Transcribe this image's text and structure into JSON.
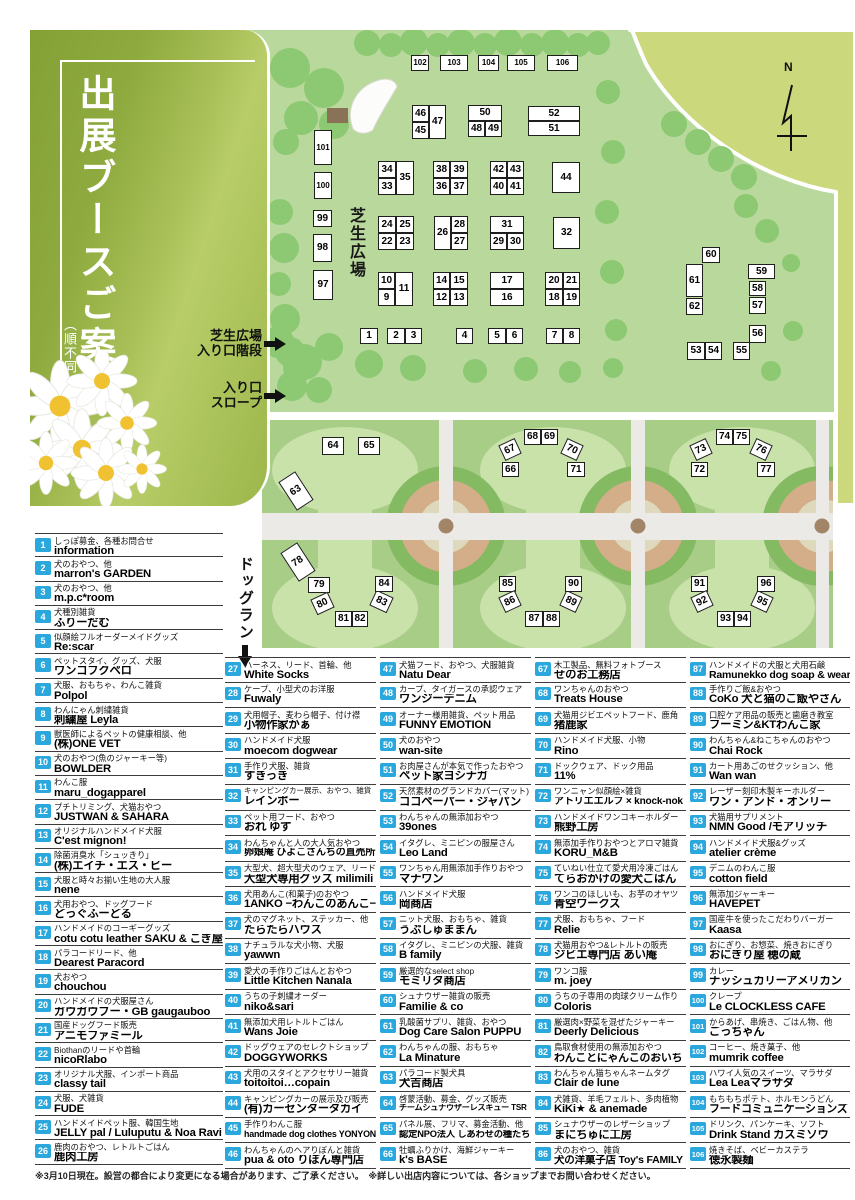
{
  "title": {
    "main": "出展ブースご案内",
    "sub": "（順不同）"
  },
  "map_labels": {
    "north": "N",
    "lawn": "芝生広場",
    "stairs_line1": "芝生広場",
    "stairs_line2": "入り口階段",
    "slope_line1": "入り口",
    "slope_line2": "スロープ",
    "dogrun": "ドッグラン"
  },
  "colors": {
    "badge_blue": "#2aa7dc",
    "panel_green": "#94b04a",
    "lawn_green": "#b9d99c",
    "tree_green": "#8dc873",
    "dogrun_green": "#a7cd87",
    "paddock_green": "#c8e2a9",
    "road_gray": "#eceae6",
    "ring_tan": "#d3ae88",
    "ring_green": "#84ba62",
    "wedge_green": "#cbd87c"
  },
  "map_boxes": [
    [
      1,
      360,
      328,
      18,
      16,
      0
    ],
    [
      2,
      387,
      328,
      18,
      16,
      0
    ],
    [
      3,
      405,
      328,
      17,
      16,
      0
    ],
    [
      4,
      456,
      328,
      17,
      16,
      0
    ],
    [
      5,
      488,
      328,
      18,
      16,
      0
    ],
    [
      6,
      506,
      328,
      17,
      16,
      0
    ],
    [
      7,
      546,
      328,
      17,
      16,
      0
    ],
    [
      8,
      563,
      328,
      17,
      16,
      0
    ],
    [
      9,
      378,
      289,
      17,
      17,
      0
    ],
    [
      10,
      378,
      272,
      17,
      17,
      0
    ],
    [
      11,
      395,
      272,
      18,
      34,
      0
    ],
    [
      12,
      433,
      289,
      17,
      17,
      0
    ],
    [
      13,
      450,
      289,
      18,
      17,
      0
    ],
    [
      14,
      433,
      272,
      17,
      17,
      0
    ],
    [
      15,
      450,
      272,
      18,
      17,
      0
    ],
    [
      16,
      490,
      289,
      34,
      17,
      0
    ],
    [
      17,
      490,
      272,
      34,
      17,
      0
    ],
    [
      18,
      545,
      289,
      18,
      17,
      0
    ],
    [
      19,
      563,
      289,
      17,
      17,
      0
    ],
    [
      20,
      545,
      272,
      18,
      17,
      0
    ],
    [
      21,
      563,
      272,
      17,
      17,
      0
    ],
    [
      22,
      378,
      233,
      18,
      17,
      0
    ],
    [
      23,
      396,
      233,
      18,
      17,
      0
    ],
    [
      24,
      378,
      216,
      18,
      17,
      0
    ],
    [
      25,
      396,
      216,
      18,
      17,
      0
    ],
    [
      26,
      434,
      216,
      17,
      34,
      0
    ],
    [
      27,
      451,
      233,
      17,
      17,
      0
    ],
    [
      28,
      451,
      216,
      17,
      17,
      0
    ],
    [
      29,
      490,
      233,
      17,
      17,
      0
    ],
    [
      30,
      507,
      233,
      17,
      17,
      0
    ],
    [
      31,
      490,
      216,
      34,
      17,
      0
    ],
    [
      32,
      553,
      217,
      27,
      32,
      0
    ],
    [
      33,
      378,
      178,
      18,
      17,
      0
    ],
    [
      34,
      378,
      161,
      18,
      17,
      0
    ],
    [
      35,
      396,
      161,
      18,
      34,
      0
    ],
    [
      36,
      433,
      178,
      17,
      17,
      0
    ],
    [
      37,
      450,
      178,
      18,
      17,
      0
    ],
    [
      38,
      433,
      161,
      17,
      17,
      0
    ],
    [
      39,
      450,
      161,
      18,
      17,
      0
    ],
    [
      40,
      490,
      178,
      17,
      17,
      0
    ],
    [
      41,
      507,
      178,
      17,
      17,
      0
    ],
    [
      42,
      490,
      161,
      17,
      17,
      0
    ],
    [
      43,
      507,
      161,
      17,
      17,
      0
    ],
    [
      44,
      552,
      162,
      28,
      31,
      0
    ],
    [
      45,
      412,
      122,
      17,
      17,
      0
    ],
    [
      46,
      412,
      105,
      17,
      17,
      0
    ],
    [
      47,
      429,
      105,
      17,
      34,
      0
    ],
    [
      48,
      468,
      121,
      17,
      16,
      0
    ],
    [
      49,
      485,
      121,
      17,
      16,
      0
    ],
    [
      50,
      468,
      105,
      34,
      16,
      0
    ],
    [
      51,
      528,
      121,
      52,
      15,
      0
    ],
    [
      52,
      528,
      106,
      52,
      15,
      0
    ],
    [
      53,
      687,
      342,
      18,
      18,
      0
    ],
    [
      54,
      705,
      342,
      17,
      18,
      0
    ],
    [
      55,
      733,
      342,
      17,
      18,
      0
    ],
    [
      56,
      749,
      325,
      17,
      18,
      0
    ],
    [
      57,
      749,
      297,
      17,
      17,
      0
    ],
    [
      58,
      749,
      281,
      17,
      15,
      0
    ],
    [
      59,
      748,
      264,
      27,
      15,
      0
    ],
    [
      60,
      702,
      247,
      18,
      16,
      0
    ],
    [
      61,
      686,
      264,
      17,
      33,
      0
    ],
    [
      62,
      686,
      298,
      17,
      17,
      0
    ],
    [
      63,
      286,
      474,
      20,
      34,
      -33
    ],
    [
      64,
      322,
      437,
      22,
      18,
      0
    ],
    [
      65,
      358,
      437,
      22,
      18,
      0
    ],
    [
      66,
      502,
      462,
      17,
      15,
      0
    ],
    [
      67,
      501,
      441,
      18,
      17,
      -25
    ],
    [
      68,
      524,
      429,
      17,
      16,
      0
    ],
    [
      69,
      541,
      429,
      17,
      16,
      0
    ],
    [
      70,
      563,
      441,
      18,
      17,
      25
    ],
    [
      71,
      567,
      462,
      18,
      15,
      0
    ],
    [
      72,
      691,
      462,
      17,
      15,
      0
    ],
    [
      73,
      692,
      441,
      18,
      17,
      -25
    ],
    [
      74,
      716,
      429,
      17,
      16,
      0
    ],
    [
      75,
      733,
      429,
      17,
      16,
      0
    ],
    [
      76,
      752,
      441,
      18,
      17,
      25
    ],
    [
      77,
      757,
      462,
      18,
      15,
      0
    ],
    [
      78,
      288,
      545,
      20,
      34,
      -33
    ],
    [
      79,
      308,
      577,
      22,
      16,
      0
    ],
    [
      80,
      313,
      595,
      19,
      17,
      -25
    ],
    [
      81,
      335,
      611,
      17,
      16,
      0
    ],
    [
      82,
      352,
      611,
      16,
      16,
      0
    ],
    [
      83,
      372,
      593,
      19,
      17,
      25
    ],
    [
      84,
      375,
      576,
      18,
      16,
      0
    ],
    [
      85,
      499,
      576,
      17,
      16,
      0
    ],
    [
      86,
      501,
      593,
      18,
      17,
      -25
    ],
    [
      87,
      525,
      611,
      18,
      16,
      0
    ],
    [
      88,
      543,
      611,
      17,
      16,
      0
    ],
    [
      89,
      562,
      593,
      18,
      17,
      25
    ],
    [
      90,
      565,
      576,
      17,
      16,
      0
    ],
    [
      91,
      691,
      576,
      17,
      16,
      0
    ],
    [
      92,
      693,
      593,
      18,
      17,
      -25
    ],
    [
      93,
      717,
      611,
      17,
      16,
      0
    ],
    [
      94,
      734,
      611,
      17,
      16,
      0
    ],
    [
      95,
      753,
      593,
      18,
      17,
      25
    ],
    [
      96,
      757,
      576,
      18,
      16,
      0
    ],
    [
      97,
      313,
      270,
      20,
      30,
      0
    ],
    [
      98,
      313,
      234,
      19,
      28,
      0
    ],
    [
      99,
      313,
      210,
      19,
      17,
      0
    ],
    [
      100,
      314,
      172,
      18,
      27,
      0
    ],
    [
      101,
      314,
      130,
      18,
      35,
      0
    ],
    [
      102,
      411,
      55,
      18,
      16,
      0
    ],
    [
      103,
      440,
      55,
      28,
      16,
      0
    ],
    [
      104,
      478,
      55,
      21,
      16,
      0
    ],
    [
      105,
      507,
      55,
      28,
      16,
      0
    ],
    [
      106,
      547,
      55,
      31,
      16,
      0
    ]
  ],
  "booths": [
    {
      "n": 1,
      "desc": "しっぽ募金、各種お問合せ",
      "name": "information"
    },
    {
      "n": 2,
      "desc": "犬のおやつ、他",
      "name": "marron's GARDEN"
    },
    {
      "n": 3,
      "desc": "犬のおやつ、他",
      "name": "m.p.c*room"
    },
    {
      "n": 4,
      "desc": "犬種別雑貨",
      "name": "ふりーだむ"
    },
    {
      "n": 5,
      "desc": "似顔絵フルオーダーメイドグッズ",
      "name": "Re:scar"
    },
    {
      "n": 6,
      "desc": "ペットスタイ、グッズ、犬服",
      "name": "ワンコフクペロ"
    },
    {
      "n": 7,
      "desc": "犬服、おもちゃ、わんこ雑貨",
      "name": "Polpol"
    },
    {
      "n": 8,
      "desc": "わんにゃん刺繍雑貨",
      "name": "刺繍屋 Leyla"
    },
    {
      "n": 9,
      "desc": "獣医師によるペットの健康相談、他",
      "name": "(株)ONE VET"
    },
    {
      "n": 10,
      "desc": "犬のおやつ(魚のジャーキー等)",
      "name": "BOWLDER"
    },
    {
      "n": 11,
      "desc": "わんこ服",
      "name": "maru_dogapparel"
    },
    {
      "n": 12,
      "desc": "プチトリミング、犬猫おやつ",
      "name": "JUSTWAN & SAHARA"
    },
    {
      "n": 13,
      "desc": "オリジナルハンドメイド犬服",
      "name": "C'est mignon!"
    },
    {
      "n": 14,
      "desc": "除菌消臭水「シュッきり」",
      "name": "(株)エイチ・エス・ビー"
    },
    {
      "n": 15,
      "desc": "犬服と時々お揃い生地の大人服",
      "name": "nene"
    },
    {
      "n": 16,
      "desc": "犬用おやつ、ドッグフード",
      "name": "どっぐふーどる"
    },
    {
      "n": 17,
      "desc": "ハンドメイドのコーギーグッズ",
      "name": "cotu cotu leather SAKU & こぎ屋"
    },
    {
      "n": 18,
      "desc": "パラコードリード、他",
      "name": "Dearest Paracord"
    },
    {
      "n": 19,
      "desc": "犬おやつ",
      "name": "chouchou"
    },
    {
      "n": 20,
      "desc": "ハンドメイドの犬服屋さん",
      "name": "ガウガウブー・GB gaugauboo"
    },
    {
      "n": 21,
      "desc": "国産ドッグフード販売",
      "name": "アニモファミール"
    },
    {
      "n": 22,
      "desc": "Biothanのリードや首輪",
      "name": "nicoRlabo"
    },
    {
      "n": 23,
      "desc": "オリジナル犬服、インポート商品",
      "name": "classy tail"
    },
    {
      "n": 24,
      "desc": "犬服、犬雑貨",
      "name": "FUDE"
    },
    {
      "n": 25,
      "desc": "ハンドメイドペット服、韓国生地",
      "name": "JELLY pal / Luluputu & Noa Ravi"
    },
    {
      "n": 26,
      "desc": "鹿肉のおやつ、レトルトごはん",
      "name": "鹿肉工房"
    },
    {
      "n": 27,
      "desc": "ハーネス、リード、首輪、他",
      "name": "White Socks"
    },
    {
      "n": 28,
      "desc": "ケープ、小型犬のお洋服",
      "name": "Fuwaly"
    },
    {
      "n": 29,
      "desc": "犬用帽子、麦わら帽子、付け襟",
      "name": "小物作家かぁ"
    },
    {
      "n": 30,
      "desc": "ハンドメイド犬服",
      "name": "moecom dogwear"
    },
    {
      "n": 31,
      "desc": "手作り犬服、雑貨",
      "name": "すきっき"
    },
    {
      "n": 32,
      "desc": "キャンピングカー展示、おやつ、雑貨",
      "name": "レインボー"
    },
    {
      "n": 33,
      "desc": "ペット用フード、おやつ",
      "name": "おれ ゆず"
    },
    {
      "n": 34,
      "desc": "わんちゃんと人の大人気おやつ",
      "name": "卵娘庵 ひよこさんちの直売所"
    },
    {
      "n": 35,
      "desc": "大型犬、超大型犬のウェア、リード",
      "name": "大型犬専用グッズ milimili"
    },
    {
      "n": 36,
      "desc": "犬用あんこ(和菓子)のおやつ",
      "name": "1ANKO −わんこのあんこ−"
    },
    {
      "n": 37,
      "desc": "犬のマグネット、ステッカー、他",
      "name": "たらたらハウス"
    },
    {
      "n": 38,
      "desc": "ナチュラルな犬小物、犬服",
      "name": "yawwn"
    },
    {
      "n": 39,
      "desc": "愛犬の手作りごはんとおやつ",
      "name": "Little Kitchen Nanala"
    },
    {
      "n": 40,
      "desc": "うちの子刺繍オーダー",
      "name": "niko&sari"
    },
    {
      "n": 41,
      "desc": "無添加犬用レトルトごはん",
      "name": "Wans Joie"
    },
    {
      "n": 42,
      "desc": "ドッグウェアのセレクトショップ",
      "name": "DOGGYWORKS"
    },
    {
      "n": 43,
      "desc": "犬用のスタイとアクセサリー雑貨",
      "name": "toitoitoi…copain"
    },
    {
      "n": 44,
      "desc": "キャンピングカーの展示及び販売",
      "name": "(有)カーセンタータカイ"
    },
    {
      "n": 45,
      "desc": "手作りわんこ服",
      "name": "handmade dog clothes YONYON"
    },
    {
      "n": 46,
      "desc": "わんちゃんのヘアりぼんと雑貨",
      "name": "pua & oto りぼん専門店"
    },
    {
      "n": 47,
      "desc": "犬猫フード、おやつ、犬服雑貨",
      "name": "Natu Dear"
    },
    {
      "n": 48,
      "desc": "カープ、タイガースの承認ウェア",
      "name": "ワンジーデニム"
    },
    {
      "n": 49,
      "desc": "オーナー様用雑貨、ペット用品",
      "name": "FUNNY EMOTION"
    },
    {
      "n": 50,
      "desc": "犬のおやつ",
      "name": "wan-site"
    },
    {
      "n": 51,
      "desc": "お肉屋さんが本気で作ったおやつ",
      "name": "ペット家ヨシナガ"
    },
    {
      "n": 52,
      "desc": "天然素材のグランドカバー(マット)",
      "name": "ココペーパー・ジャパン"
    },
    {
      "n": 53,
      "desc": "わんちゃんの無添加おやつ",
      "name": "39ones"
    },
    {
      "n": 54,
      "desc": "イタグレ、ミニピンの服屋さん",
      "name": "Leo Land"
    },
    {
      "n": 55,
      "desc": "ワンちゃん用無添加手作りおやつ",
      "name": "マナワン"
    },
    {
      "n": 56,
      "desc": "ハンドメイド犬服",
      "name": "岡商店"
    },
    {
      "n": 57,
      "desc": "ニット犬服、おもちゃ、雑貨",
      "name": "うぶしゅままん"
    },
    {
      "n": 58,
      "desc": "イタグレ、ミニピンの犬服、雑貨",
      "name": "B family"
    },
    {
      "n": 59,
      "desc": "厳選的なselect shop",
      "name": "モミリタ商店"
    },
    {
      "n": 60,
      "desc": "シュナウザー雑貨の販売",
      "name": "Familie & co"
    },
    {
      "n": 61,
      "desc": "乳酸菌サプリ、雑貨、おやつ",
      "name": "Dog Care Salon PUPPU"
    },
    {
      "n": 62,
      "desc": "わんちゃんの服、おもちゃ",
      "name": "La Minature"
    },
    {
      "n": 63,
      "desc": "パラコード製犬具",
      "name": "犬吉商店"
    },
    {
      "n": 64,
      "desc": "啓蒙活動、募金、グッズ販売",
      "name": "チームシュナウザーレスキュー TSR"
    },
    {
      "n": 65,
      "desc": "パネル展、フリマ、募金活動、他",
      "name": "認定NPO法人 しあわせの種たち"
    },
    {
      "n": 66,
      "desc": "牡蠣ふりかけ、海鮮ジャーキー",
      "name": "k's BASE"
    },
    {
      "n": 67,
      "desc": "木工製品、無料フォトブース",
      "name": "せのお工務店"
    },
    {
      "n": 68,
      "desc": "ワンちゃんのおやつ",
      "name": "Treats House"
    },
    {
      "n": 69,
      "desc": "犬猫用ジビエペットフード、鹿角",
      "name": "猪鹿家"
    },
    {
      "n": 70,
      "desc": "ハンドメイド犬服、小物",
      "name": "Rino"
    },
    {
      "n": 71,
      "desc": "ドックウェア、ドック用品",
      "name": "11%"
    },
    {
      "n": 72,
      "desc": "ワンニャン似顔絵×雑貨",
      "name": "アトリエエルフ × knock-nok"
    },
    {
      "n": 73,
      "desc": "ハンドメイドワンコキーホルダー",
      "name": "熊野工房"
    },
    {
      "n": 74,
      "desc": "無添加手作りおやつとアロマ雑貨",
      "name": "KORU_M&B"
    },
    {
      "n": 75,
      "desc": "ていねい仕立て愛犬用冷凍ごはん",
      "name": "てらおかけの愛犬ごはん"
    },
    {
      "n": 76,
      "desc": "ワンコのほしいも、お芋のオヤツ",
      "name": "青空ワークス"
    },
    {
      "n": 77,
      "desc": "犬服、おもちゃ、フード",
      "name": "Relie"
    },
    {
      "n": 78,
      "desc": "犬猫用おやつ&レトルトの販売",
      "name": "ジビエ専門店 あい庵"
    },
    {
      "n": 79,
      "desc": "ワンコ服",
      "name": "m. joey"
    },
    {
      "n": 80,
      "desc": "うちの子専用の肉球クリーム作り",
      "name": "Coloris"
    },
    {
      "n": 81,
      "desc": "厳選肉×野菜を混ぜたジャーキー",
      "name": "Deerly Delicious"
    },
    {
      "n": 82,
      "desc": "鳥取食材使用の無添加おやつ",
      "name": "わんことにゃんこのおいち"
    },
    {
      "n": 83,
      "desc": "わんちゃん猫ちゃんネームタグ",
      "name": "Clair de lune"
    },
    {
      "n": 84,
      "desc": "犬雑貨、羊毛フェルト、多肉植物",
      "name": "KiKi★ & anemade"
    },
    {
      "n": 85,
      "desc": "シュナウザーのレザーショップ",
      "name": "まにちゅに工房"
    },
    {
      "n": 86,
      "desc": "犬のおやつ、雑貨",
      "name": "犬の洋菓子店 Toy's FAMILY"
    },
    {
      "n": 87,
      "desc": "ハンドメイドの犬服と犬用石鹸",
      "name": "Ramunekko dog soap & wear"
    },
    {
      "n": 88,
      "desc": "手作りご飯&おやつ",
      "name": "CoKo 犬と猫のご飯やさん"
    },
    {
      "n": 89,
      "desc": "口腔ケア用品の販売と歯磨き教室",
      "name": "フーミン&KTわんこ家"
    },
    {
      "n": 90,
      "desc": "わんちゃん&ねこちゃんのおやつ",
      "name": "Chai Rock"
    },
    {
      "n": 91,
      "desc": "カート用あごのせクッション、他",
      "name": "Wan wan"
    },
    {
      "n": 92,
      "desc": "レーザー刻印木製キーホルダー",
      "name": "ワン・アンド・オンリー"
    },
    {
      "n": 93,
      "desc": "犬猫用サプリメント",
      "name": "NMN Good /モアリッチ"
    },
    {
      "n": 94,
      "desc": "ハンドメイド犬服&グッズ",
      "name": "atelier crème"
    },
    {
      "n": 95,
      "desc": "デニムのわんこ服",
      "name": "cotton field"
    },
    {
      "n": 96,
      "desc": "無添加ジャーキー",
      "name": "HAVEPET"
    },
    {
      "n": 97,
      "desc": "国産牛を使ったこだわりバーガー",
      "name": "Kaasa"
    },
    {
      "n": 98,
      "desc": "おにぎり、お惣菜、焼きおにぎり",
      "name": "おにぎり屋 穂の蔵"
    },
    {
      "n": 99,
      "desc": "カレー",
      "name": "ナッシュカリーアメリカン"
    },
    {
      "n": 100,
      "desc": "クレープ",
      "name": "Le CLOCKLESS CAFE"
    },
    {
      "n": 101,
      "desc": "からあげ、串焼き、ごはん物、他",
      "name": "ごっちゃん"
    },
    {
      "n": 102,
      "desc": "コーヒー、焼き菓子、他",
      "name": "mumrik coffee"
    },
    {
      "n": 103,
      "desc": "ハワイ人気のスイーツ、マラサダ",
      "name": "Lea Leaマラサダ"
    },
    {
      "n": 104,
      "desc": "もちもちポテト、ホルモンうどん",
      "name": "フードコミュニケーションズ"
    },
    {
      "n": 105,
      "desc": "ドリンク、パンケーキ、ソフト",
      "name": "Drink Stand カスミソウ"
    },
    {
      "n": 106,
      "desc": "焼きそば、ベビーカステラ",
      "name": "徳永製麺"
    }
  ],
  "footer": "※3月10日現在。設営の都合により変更になる場合があります、ご了承ください。　※詳しい出店内容については、各ショップまでお問い合わせください。"
}
